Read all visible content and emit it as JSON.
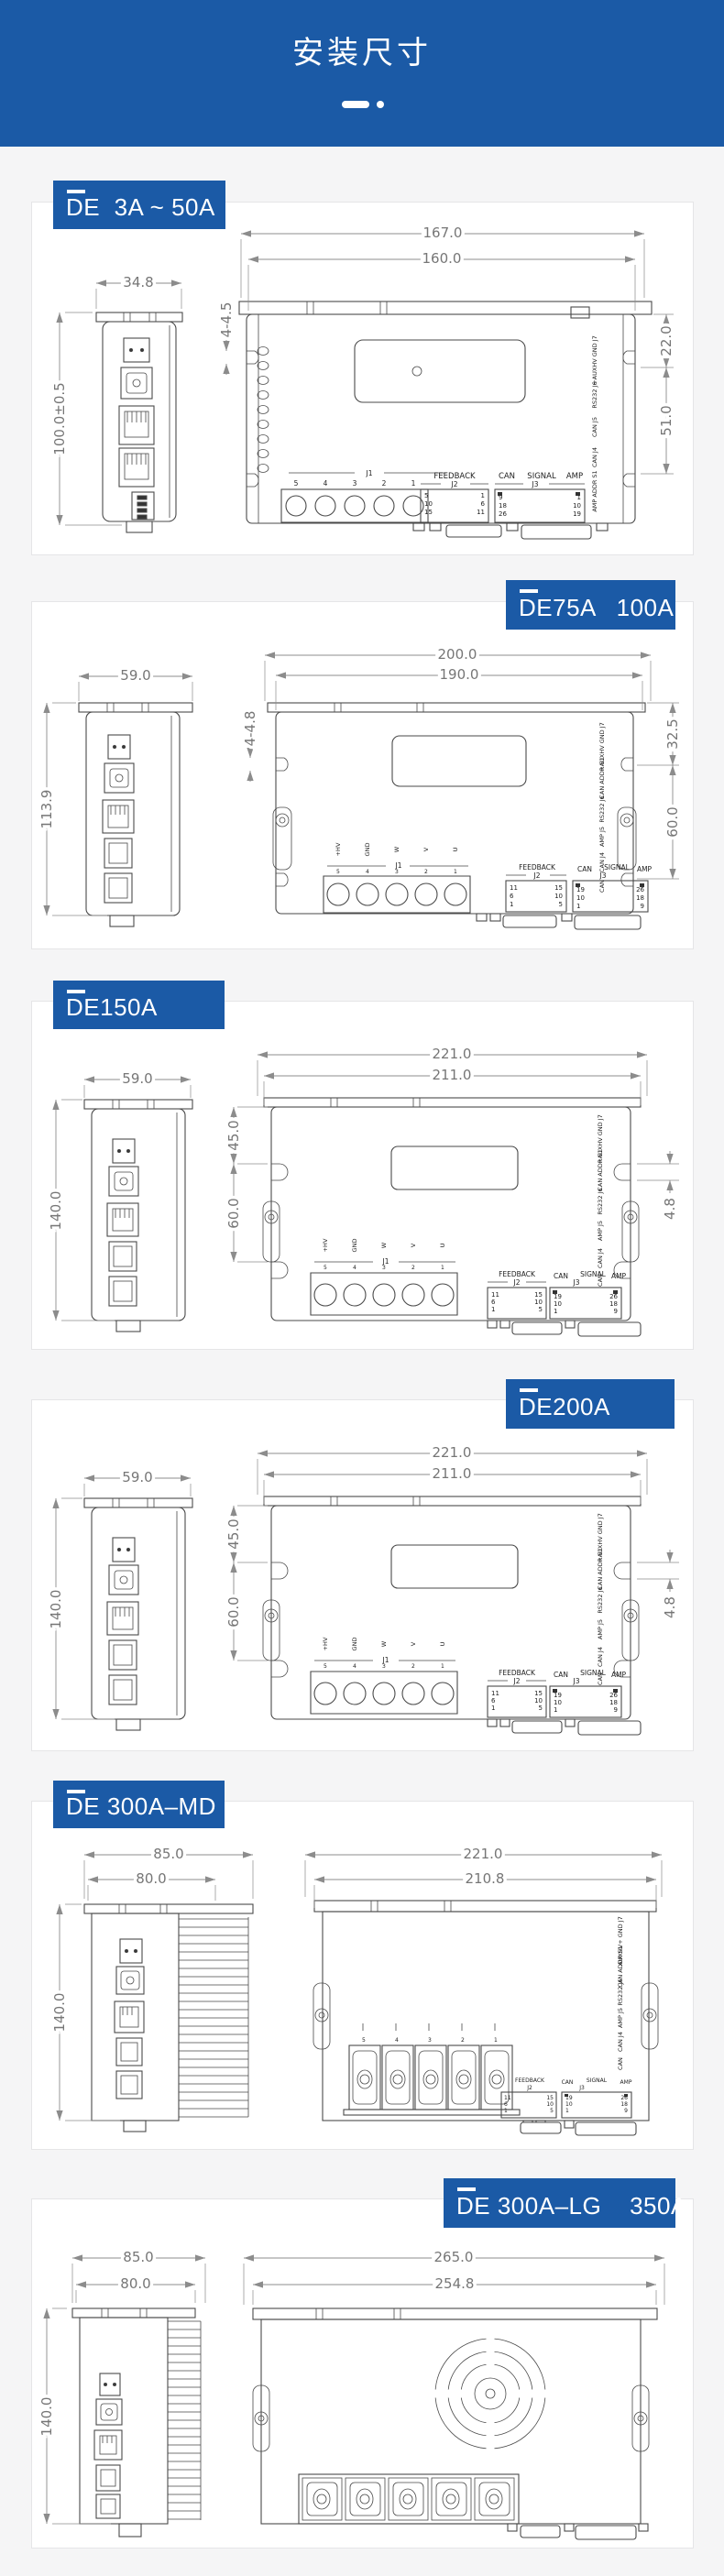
{
  "header": {
    "title": "安装尺寸"
  },
  "sections": [
    {
      "id": "de-3a-50a",
      "label": "DE  3A ~ 50A",
      "dims": {
        "side_w": "34.8",
        "side_h": "100.0±0.5",
        "front_w_outer": "167.0",
        "front_w_inner": "160.0",
        "holes": "4-4.5",
        "right_top": "22.0",
        "right_bottom": "51.0"
      },
      "j1": {
        "name": "J1",
        "pins": [
          "5",
          "4",
          "3",
          "2",
          "1"
        ]
      },
      "j2": {
        "title": "FEEDBACK",
        "name": "J2",
        "pins_left": [
          "5",
          "10",
          "15"
        ],
        "pins_right": [
          "1",
          "6",
          "11"
        ]
      },
      "j3": {
        "title_left": "CAN",
        "title_right": "SIGNAL",
        "name": "J3",
        "amp": "AMP",
        "pins_left": [
          "9",
          "18",
          "26"
        ],
        "pins_right": [
          "1",
          "10",
          "19"
        ]
      },
      "right_labels": [
        "+AUXHV GND  J7",
        "RS232  J6",
        "CAN  J5",
        "CAN  J4",
        "AMP ADDR  S1"
      ]
    },
    {
      "id": "de75a-100a",
      "label": "DE75A   100A",
      "dims": {
        "side_w": "59.0",
        "side_h": "113.9",
        "front_w_outer": "200.0",
        "front_w_inner": "190.0",
        "holes": "4-4.8",
        "right_top": "32.5",
        "right_bottom": "60.0"
      },
      "power": [
        "+HV",
        "GND",
        "W",
        "V",
        "U"
      ],
      "j1": {
        "name": "J1",
        "pins": [
          "5",
          "4",
          "3",
          "2",
          "1"
        ]
      },
      "j2": {
        "title": "FEEDBACK",
        "name": "J2",
        "pins_left": [
          "11",
          "6",
          "1"
        ],
        "pins_right": [
          "15",
          "10",
          "5"
        ]
      },
      "j3": {
        "title_left": "CAN",
        "title_right": "SIGNAL",
        "name": "J3",
        "amp": "AMP",
        "pins_left": [
          "19",
          "10",
          "1"
        ],
        "pins_right": [
          "26",
          "18",
          "9"
        ]
      },
      "right_labels": [
        "+AUXHV GND  J7",
        "CAN ADDR  S1",
        "RS232  J6",
        "AMP  J5",
        "CAN  J4",
        "CAN"
      ]
    },
    {
      "id": "de150a",
      "label": "DE150A",
      "dims": {
        "side_w": "59.0",
        "side_h": "140.0",
        "front_w_outer": "221.0",
        "front_w_inner": "211.0",
        "left_top": "45.0",
        "left_bottom": "60.0",
        "right": "4.8"
      },
      "power": [
        "+HV",
        "GND",
        "W",
        "V",
        "U"
      ],
      "j1": {
        "name": "J1",
        "pins": [
          "5",
          "4",
          "3",
          "2",
          "1"
        ]
      },
      "j2": {
        "title": "FEEDBACK",
        "name": "J2",
        "pins_left": [
          "11",
          "6",
          "1"
        ],
        "pins_right": [
          "15",
          "10",
          "5"
        ]
      },
      "j3": {
        "title_left": "CAN",
        "title_right": "SIGNAL",
        "name": "J3",
        "amp": "AMP",
        "pins_left": [
          "19",
          "10",
          "1"
        ],
        "pins_right": [
          "26",
          "18",
          "9"
        ]
      },
      "right_labels": [
        "+AUXHV GND  J7",
        "CAN ADDR  S1",
        "RS232  J6",
        "AMP  J5",
        "CAN  J4",
        "CAN"
      ]
    },
    {
      "id": "de200a",
      "label": "DE200A",
      "dims": {
        "side_w": "59.0",
        "side_h": "140.0",
        "front_w_outer": "221.0",
        "front_w_inner": "211.0",
        "left_top": "45.0",
        "left_bottom": "60.0",
        "right": "4.8"
      },
      "power": [
        "+HV",
        "GND",
        "W",
        "V",
        "U"
      ],
      "j1": {
        "name": "J1",
        "pins": [
          "5",
          "4",
          "3",
          "2",
          "1"
        ]
      },
      "j2": {
        "title": "FEEDBACK",
        "name": "J2",
        "pins_left": [
          "11",
          "6",
          "1"
        ],
        "pins_right": [
          "15",
          "10",
          "5"
        ]
      },
      "j3": {
        "title_left": "CAN",
        "title_right": "SIGNAL",
        "name": "J3",
        "amp": "AMP",
        "pins_left": [
          "19",
          "10",
          "1"
        ],
        "pins_right": [
          "26",
          "18",
          "9"
        ]
      },
      "right_labels": [
        "+AUXHV GND  J7",
        "CAN ADDR  S1",
        "RS232  J6",
        "AMP  J5",
        "CAN  J4",
        "CAN"
      ]
    },
    {
      "id": "de300a-md",
      "label": "DE 300A–MD",
      "dims": {
        "side_w_outer": "85.0",
        "side_w_inner": "80.0",
        "side_h": "140.0",
        "front_w_outer": "221.0",
        "front_w_inner": "210.8"
      },
      "pins": [
        "5",
        "4",
        "3",
        "2",
        "1"
      ],
      "j2": {
        "title": "FEEDBACK",
        "name": "J2",
        "pins_left": [
          "11",
          "6",
          "1"
        ],
        "pins_right": [
          "15",
          "10",
          "5"
        ]
      },
      "j3": {
        "title_left": "CAN",
        "title_right": "SIGNAL",
        "name": "J3",
        "amp": "AMP",
        "pins_left": [
          "19",
          "10",
          "1"
        ],
        "pins_right": [
          "26",
          "18",
          "9"
        ]
      },
      "right_labels": [
        "AUXHV+ GND  J7",
        "CAN ADDR  S1",
        "RS232  J6",
        "AMP  J5",
        "CAN  J4",
        "CAN"
      ]
    },
    {
      "id": "de300a-lg-350a",
      "label": "DE 300A–LG    350A",
      "dims": {
        "side_w_outer": "85.0",
        "side_w_inner": "80.0",
        "side_h": "140.0",
        "front_w_outer": "265.0",
        "front_w_inner": "254.8"
      }
    }
  ]
}
